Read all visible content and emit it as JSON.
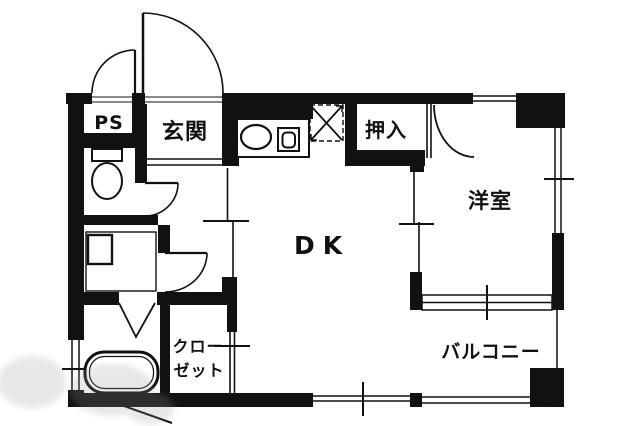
{
  "plan": {
    "title": "1DK apartment floor plan",
    "rooms": {
      "ps": "PS",
      "entrance": "玄関",
      "oshiire": "押入",
      "western_room": "洋室",
      "dining_kitchen": "DK",
      "closet_line1": "クロー",
      "closet_line2": "ゼット",
      "balcony": "バルコニー"
    },
    "fixtures": {
      "toilet": "toilet-icon",
      "kitchen_sink": "kitchen-sink-icon",
      "stove": "gas-stove-icon",
      "refrigerator_space": "refrigerator-space-x-icon",
      "washing_machine_pan": "washing-machine-pan-icon",
      "bathtub": "bathtub-icon",
      "folding_door": "folding-door-icon"
    },
    "colors": {
      "wall": "#111111",
      "line": "#1a1a1a",
      "background": "#ffffff",
      "watermark": "#9b958b"
    }
  }
}
